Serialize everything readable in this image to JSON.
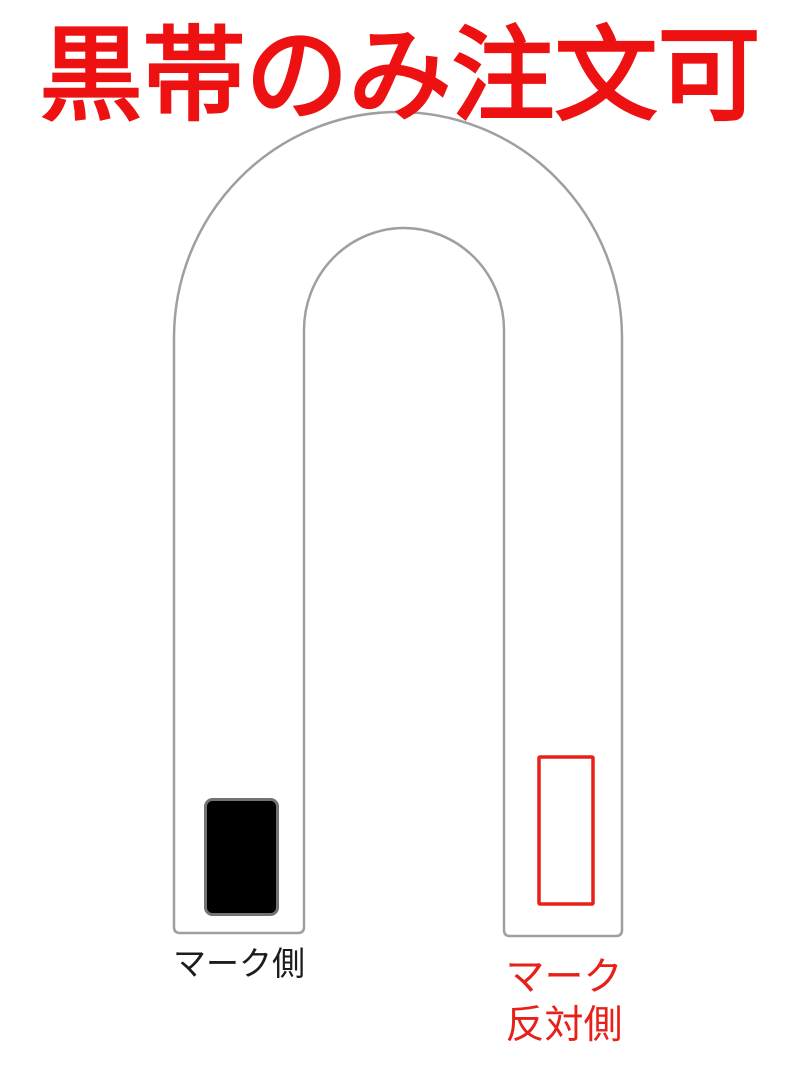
{
  "page": {
    "background": "#ffffff"
  },
  "heading": {
    "text": "黒帯のみ注文可",
    "color": "#ee1111"
  },
  "belt": {
    "outline_color": "#9f9f9f",
    "fill": "#ffffff",
    "mark_patch": {
      "fill": "#000000",
      "border_color": "#737373"
    },
    "opposite_patch": {
      "outline_color": "#e8201a",
      "fill": "none"
    },
    "label_mark_side": {
      "text": "マーク側",
      "color": "#1c1c1c"
    },
    "label_opposite_side": {
      "line1": "マーク",
      "line2": "反対側",
      "color": "#e8201a"
    }
  }
}
